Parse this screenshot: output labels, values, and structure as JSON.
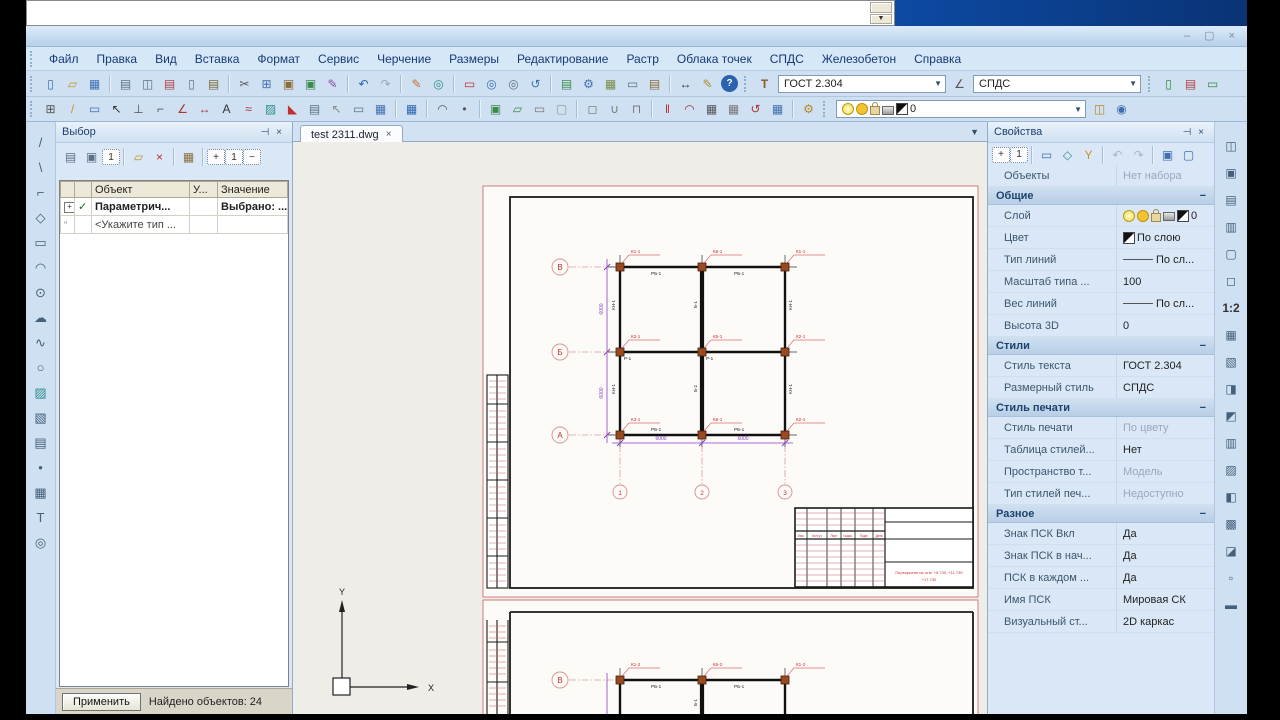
{
  "window": {
    "buttons": [
      "–",
      "▢",
      "×"
    ]
  },
  "menus": [
    "Файл",
    "Правка",
    "Вид",
    "Вставка",
    "Формат",
    "Сервис",
    "Черчение",
    "Размеры",
    "Редактирование",
    "Растр",
    "Облака точек",
    "СПДС",
    "Железобетон",
    "Справка"
  ],
  "toolbars": {
    "text_style": "ГОСТ 2.304",
    "dim_style": "СПДС",
    "layer_current": "0",
    "main1": [
      {
        "n": "new-file",
        "g": "▯",
        "c": "#3f6fae"
      },
      {
        "n": "open-file",
        "g": "▱",
        "c": "#c79428"
      },
      {
        "n": "save-file",
        "g": "▦",
        "c": "#3f6fae"
      },
      {
        "sep": 1
      },
      {
        "n": "print",
        "g": "▤",
        "c": "#5a7186"
      },
      {
        "n": "print-preview",
        "g": "◫",
        "c": "#5a7186"
      },
      {
        "n": "plot",
        "g": "▤",
        "c": "#b04040"
      },
      {
        "n": "page-setup",
        "g": "▯",
        "c": "#5a7186"
      },
      {
        "n": "publish",
        "g": "▤",
        "c": "#7a6a3a"
      },
      {
        "sep": 1
      },
      {
        "n": "cut",
        "g": "✂",
        "c": "#555555"
      },
      {
        "n": "copy",
        "g": "⊞",
        "c": "#3f6fae"
      },
      {
        "n": "paste",
        "g": "▣",
        "c": "#8a6d3b"
      },
      {
        "n": "paste-special",
        "g": "▣",
        "c": "#3b8a4a"
      },
      {
        "n": "copy-properties",
        "g": "✎",
        "c": "#8a4a9e"
      },
      {
        "sep": 1
      },
      {
        "n": "undo",
        "g": "↶",
        "c": "#2b62b0"
      },
      {
        "n": "redo",
        "g": "↷",
        "c": "#9aa7b5"
      },
      {
        "sep": 1
      },
      {
        "n": "erase",
        "g": "✎",
        "c": "#c4722a"
      },
      {
        "n": "regen",
        "g": "◎",
        "c": "#2f8f8f"
      },
      {
        "sep": 1
      },
      {
        "n": "zoom-window",
        "g": "▭",
        "c": "#c03030"
      },
      {
        "n": "zoom-in",
        "g": "◎",
        "c": "#3f6fae"
      },
      {
        "n": "zoom-out",
        "g": "◎",
        "c": "#5a7186"
      },
      {
        "n": "zoom-previous",
        "g": "↺",
        "c": "#3f6fae"
      },
      {
        "sep": 1
      },
      {
        "n": "draft-settings",
        "g": "▤",
        "c": "#3b8a4a"
      },
      {
        "n": "options",
        "g": "⚙",
        "c": "#3f6fae"
      },
      {
        "n": "render",
        "g": "▦",
        "c": "#7a8a44"
      },
      {
        "n": "keyboard",
        "g": "▭",
        "c": "#5a7186"
      },
      {
        "n": "reference-book",
        "g": "▤",
        "c": "#8a6d3b"
      },
      {
        "sep": 1
      },
      {
        "n": "limits",
        "g": "↔",
        "c": "#333333"
      },
      {
        "n": "quick-edit",
        "g": "✎",
        "c": "#b58a2a"
      },
      {
        "n": "help",
        "g": "?",
        "cls": "help"
      }
    ],
    "main1_end": [
      {
        "n": "new-sheet",
        "g": "▯",
        "c": "#2a8a3a"
      },
      {
        "n": "chart-view",
        "g": "▤",
        "c": "#b04040"
      },
      {
        "n": "notes",
        "g": "▭",
        "c": "#3b8a4a"
      }
    ],
    "main2": [
      {
        "n": "osnap",
        "g": "⊞",
        "c": "#555555"
      },
      {
        "n": "draw-line",
        "g": "/",
        "c": "#c79428"
      },
      {
        "n": "block",
        "g": "▭",
        "c": "#3f6fae"
      },
      {
        "n": "select",
        "g": "↖",
        "c": "#333333"
      },
      {
        "n": "ortho",
        "g": "⊥",
        "c": "#555555"
      },
      {
        "n": "polyline-tool",
        "g": "⌐",
        "c": "#555555"
      },
      {
        "n": "angle-dim",
        "g": "∠",
        "c": "#aa3333"
      },
      {
        "n": "aligned-dim",
        "g": "↔",
        "c": "#aa3333"
      },
      {
        "n": "text-tool",
        "g": "A",
        "c": "#333333"
      },
      {
        "n": "mtext-tool",
        "g": "≈",
        "c": "#aa3333"
      },
      {
        "n": "hatch-tool",
        "g": "▨",
        "c": "#2f8f8f"
      },
      {
        "n": "gradient-tool",
        "g": "◣",
        "c": "#c03030"
      },
      {
        "n": "raster-image",
        "g": "▤",
        "c": "#5a7186"
      },
      {
        "n": "select-similar",
        "g": "↖",
        "c": "#888888"
      },
      {
        "n": "viewport",
        "g": "▭",
        "c": "#5a7186"
      },
      {
        "n": "layout-grid",
        "g": "▦",
        "c": "#3f6fae"
      },
      {
        "sep": 1
      },
      {
        "n": "calculator",
        "g": "▦",
        "c": "#2b62b0"
      },
      {
        "sep": 1
      },
      {
        "n": "arc-tool",
        "g": "◠",
        "c": "#555555"
      },
      {
        "n": "point-tool",
        "g": "•",
        "c": "#555555"
      },
      {
        "sep": 1
      },
      {
        "n": "copy-object",
        "g": "▣",
        "c": "#3b8a4a"
      },
      {
        "n": "clip",
        "g": "▱",
        "c": "#3b8a4a"
      },
      {
        "n": "box-3d",
        "g": "▭",
        "c": "#777777"
      },
      {
        "n": "empty-slot",
        "g": "▢",
        "c": "#999999"
      },
      {
        "sep": 1
      },
      {
        "n": "u-shape",
        "g": "◻",
        "c": "#777777"
      },
      {
        "n": "weld-seam",
        "g": "∪",
        "c": "#777777"
      },
      {
        "n": "bracket",
        "g": "⊓",
        "c": "#777777"
      },
      {
        "sep": 1
      },
      {
        "n": "dim-chain",
        "g": "‖",
        "c": "#aa3333"
      },
      {
        "n": "dim-arc",
        "g": "◠",
        "c": "#aa3333"
      },
      {
        "n": "grid-axes",
        "g": "▦",
        "c": "#555555"
      },
      {
        "n": "grid-axes-2",
        "g": "▦",
        "c": "#777777"
      },
      {
        "n": "revision-cloud",
        "g": "↺",
        "c": "#aa3333"
      },
      {
        "n": "table-tool",
        "g": "▦",
        "c": "#3f6fae"
      },
      {
        "sep": 1
      },
      {
        "n": "quick-select",
        "g": "⚙",
        "c": "#b58a2a"
      }
    ],
    "main2_end": [
      {
        "n": "lock-layer",
        "g": "◫",
        "c": "#b58a2a"
      },
      {
        "n": "layer-states",
        "g": "◉",
        "c": "#3f6fae"
      }
    ],
    "left_tools": [
      {
        "n": "tool-line",
        "g": "/"
      },
      {
        "n": "tool-ray",
        "g": "\\"
      },
      {
        "n": "tool-polyline",
        "g": "⌐"
      },
      {
        "n": "tool-polygon",
        "g": "◇"
      },
      {
        "n": "tool-rectangle",
        "g": "▭"
      },
      {
        "n": "tool-arc",
        "g": "◠"
      },
      {
        "n": "tool-circle",
        "g": "⊙"
      },
      {
        "n": "tool-cloud",
        "g": "☁"
      },
      {
        "n": "tool-spline",
        "g": "∿"
      },
      {
        "n": "tool-ellipse",
        "g": "○"
      },
      {
        "n": "tool-hatch",
        "g": "▨",
        "c": "#2f8f8f"
      },
      {
        "n": "tool-region",
        "g": "▧"
      },
      {
        "n": "tool-image",
        "g": "▤"
      },
      {
        "n": "tool-point",
        "g": "•"
      },
      {
        "n": "tool-table",
        "g": "▦"
      },
      {
        "n": "tool-text",
        "g": "T"
      },
      {
        "n": "tool-donut",
        "g": "◎"
      }
    ],
    "right_tools": [
      {
        "n": "rt-view-full",
        "g": "◫"
      },
      {
        "n": "rt-view-sheet",
        "g": "▣"
      },
      {
        "n": "rt-viewport-1",
        "g": "▤"
      },
      {
        "n": "rt-viewport-2",
        "g": "▥"
      },
      {
        "n": "rt-box",
        "g": "▢"
      },
      {
        "n": "rt-frame",
        "g": "◻"
      },
      {
        "n": "rt-scale",
        "g": "1:2",
        "cls": "txt"
      },
      {
        "n": "rt-grid-1",
        "g": "▦"
      },
      {
        "n": "rt-grid-2",
        "g": "▧"
      },
      {
        "n": "rt-half-1",
        "g": "◨"
      },
      {
        "n": "rt-half-2",
        "g": "◩"
      },
      {
        "n": "rt-lines",
        "g": "▥"
      },
      {
        "n": "rt-hatch",
        "g": "▨"
      },
      {
        "n": "rt-half-3",
        "g": "◧"
      },
      {
        "n": "rt-dense",
        "g": "▩"
      },
      {
        "n": "rt-corner",
        "g": "◪"
      },
      {
        "n": "rt-small",
        "g": "▫"
      },
      {
        "n": "rt-bar",
        "g": "▬"
      }
    ]
  },
  "vybor": {
    "title": "Выбор",
    "toolbar": [
      {
        "n": "report-type-1",
        "g": "▤",
        "c": "#5a7186"
      },
      {
        "n": "report-type-2",
        "g": "▣",
        "c": "#5a7186"
      },
      {
        "n": "single-object",
        "g": "1",
        "cls": "boxed"
      },
      {
        "sep": 1
      },
      {
        "n": "open-selection",
        "g": "▱",
        "c": "#c79428"
      },
      {
        "n": "delete-selection",
        "g": "×",
        "c": "#c03030"
      },
      {
        "sep": 1
      },
      {
        "n": "selection-form",
        "g": "▦",
        "c": "#8a6d3b"
      },
      {
        "sep": 1
      },
      {
        "n": "expand-all",
        "g": "+",
        "cls": "boxed"
      },
      {
        "n": "level-one",
        "g": "1",
        "cls": "boxed"
      },
      {
        "n": "collapse-all",
        "g": "−",
        "cls": "boxed"
      }
    ],
    "table": {
      "headers": [
        "Объект",
        "У...",
        "Значение"
      ],
      "row1": {
        "expand": "+",
        "check": "✓",
        "object": "Параметрич...",
        "value": "Выбрано: ..."
      },
      "row2": {
        "mark": "\"",
        "object": "<Укажите тип ..."
      }
    },
    "apply_button": "Применить",
    "status": "Найдено объектов: 24"
  },
  "props": {
    "title": "Свойства",
    "toolbar": [
      {
        "n": "expand-plus",
        "g": "+",
        "cls": "boxed"
      },
      {
        "n": "level-1",
        "g": "1",
        "cls": "boxed"
      },
      {
        "sep": 1
      },
      {
        "n": "select-objects",
        "g": "▭",
        "c": "#3f6fae"
      },
      {
        "n": "select-poly",
        "g": "◇",
        "c": "#2f8f8f"
      },
      {
        "n": "quick-filter",
        "g": "Y",
        "c": "#c79428"
      },
      {
        "sep": 1
      },
      {
        "n": "prev-selection",
        "g": "↶",
        "c": "#a9b6c5"
      },
      {
        "n": "next-selection",
        "g": "↷",
        "c": "#a9b6c5"
      },
      {
        "sep": 1
      },
      {
        "n": "pickadd-toggle",
        "g": "▣",
        "c": "#3f6fae"
      },
      {
        "n": "clear-selection",
        "g": "▢",
        "c": "#3f6fae"
      }
    ],
    "rows": [
      {
        "t": "row",
        "label": "Объекты",
        "value": "Нет набора",
        "vg": 1
      },
      {
        "t": "sec",
        "label": "Общие"
      },
      {
        "t": "row",
        "label": "Слой",
        "value": "0",
        "icons": [
          "bulb",
          "sun",
          "lock",
          "printer",
          "chip"
        ]
      },
      {
        "t": "row",
        "label": "Цвет",
        "value": "По слою",
        "chip": 1
      },
      {
        "t": "row",
        "label": "Тип линий",
        "value": "По сл...",
        "line": 1
      },
      {
        "t": "row",
        "label": "Масштаб типа ...",
        "value": "100"
      },
      {
        "t": "row",
        "label": "Вес линий",
        "value": "По сл...",
        "line": 1
      },
      {
        "t": "row",
        "label": "Высота 3D",
        "value": "0"
      },
      {
        "t": "sec",
        "label": "Стили"
      },
      {
        "t": "row",
        "label": "Стиль текста",
        "value": "ГОСТ 2.304"
      },
      {
        "t": "row",
        "label": "Размерный стиль",
        "value": "СПДС"
      },
      {
        "t": "sec",
        "label": "Стиль печати"
      },
      {
        "t": "row",
        "label": "Стиль печати",
        "value": "По цвету",
        "vg": 1
      },
      {
        "t": "row",
        "label": "Таблица стилей...",
        "value": "Нет"
      },
      {
        "t": "row",
        "label": "Пространство т...",
        "value": "Модель",
        "vg": 1
      },
      {
        "t": "row",
        "label": "Тип стилей печ...",
        "value": "Недоступно",
        "vg": 1
      },
      {
        "t": "sec",
        "label": "Разное"
      },
      {
        "t": "row",
        "label": "Знак ПСК Вкл",
        "value": "Да"
      },
      {
        "t": "row",
        "label": "Знак ПСК в нач...",
        "value": "Да"
      },
      {
        "t": "row",
        "label": "ПСК в каждом ...",
        "value": "Да"
      },
      {
        "t": "row",
        "label": "Имя ПСК",
        "value": "Мировая СК"
      },
      {
        "t": "row",
        "label": "Визуальный ст...",
        "value": "2D каркас"
      }
    ]
  },
  "drawing": {
    "tab": "test 2311.dwg",
    "tab_close": "×",
    "axes_h": [
      "В",
      "Б",
      "А"
    ],
    "axes_v": [
      "1",
      "2",
      "3"
    ],
    "axis2": "В",
    "cols1": [
      "К1-1",
      "К6-1",
      "К1-1",
      "К2-1",
      "К5-1",
      "К2-1",
      "К3-1",
      "К6-1",
      "К2-1"
    ],
    "cols2": [
      "К1-2",
      "К6-2",
      "К1-2"
    ],
    "beams": {
      "rb": "РБ-1",
      "b1": "Б-1",
      "b2": "Б-2",
      "kn": "КН-1",
      "r1": "Р-1"
    },
    "dims": {
      "v1": "6000",
      "v2": "6000",
      "h1": "6000",
      "h2": "6000"
    },
    "stamp": {
      "line1": "Перекрытие на отм. +5.730, +11.730",
      "line2": "+17.730",
      "hdr": [
        "Изм.",
        "Кол.уч",
        "Лист",
        "№док.",
        "Подп.",
        "Дата"
      ]
    },
    "ucs": {
      "x": "X",
      "y": "Y"
    }
  }
}
